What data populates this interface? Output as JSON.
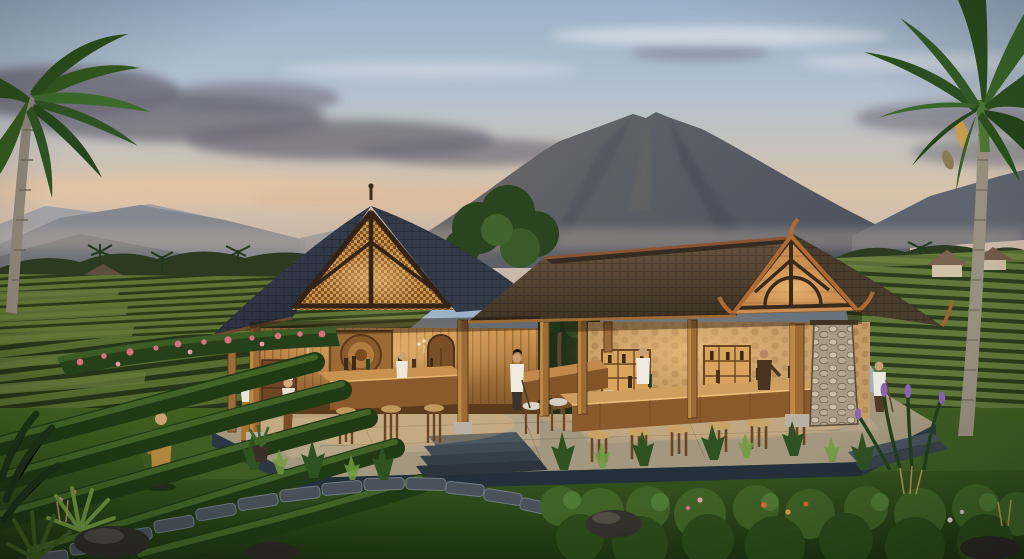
{
  "meta": {
    "type": "photorealistic-architectural-render",
    "description": "Sunset rendering of an open-air Balinese tea-house: two joined timber pavilions with steep shingled roofs and glowing carved gables, long tasting bars with wooden stools, set on a stone terrace amid terraced tea plantations, flower hedges, stepping-stone paths and royal palms, with a volcano rising behind under a peach-and-blue dusk sky.",
    "no_visible_text": true
  },
  "scene": {
    "sky": "dusk sky, blue above warm peach horizon band with grey-violet clouds",
    "mountain": "large volcano center-right with twin-notched summit",
    "left_palm": "royal palm entering frame at far left",
    "right_palm": "tall royal palm at right edge with seed pod",
    "fields": "terraced tea plantation rows left and right, two distant thatched huts",
    "building": {
      "left_pavilion": "steep slate roof, golden woven gable with dark timber trusses, carved medallion wall, tasting table with three stools",
      "right_pavilion": "brown shingle roof, lit plank gable with arched truss, river-stone walls and pillar, long bar with six stools plus cushioned stools",
      "breezeway": "open passage with small counter and courtyard tree"
    },
    "people": [
      "guest in gold robe tasting tea in the field",
      "two women in traditional dress near the steps",
      "barista in white at the breezeway",
      "barista behind the left tasting table",
      "barista in white behind the long bar",
      "server in dark vest at the bar end",
      "guest in white at the right counter"
    ],
    "garden": "flower hedge with pink blooms, fern border, stepping-stone path, boulders, agaves, purple flower spikes, clipped bush rows"
  },
  "palette": {
    "sky-top": "#9bb2ca",
    "sky-warm": "#d8c2a9",
    "mountain": "#5e6068",
    "tea-light": "#5f7434",
    "tea-dark": "#2a3a19",
    "lawn": "#3c5722",
    "roof-slate": "#3a4250",
    "roof-brown": "#65533f",
    "gable-gold": "#b37c3c",
    "wood-lit": "#c79147",
    "stone-wall": "#c49a66",
    "platform": "#a3977f",
    "glow": "#ffbe6e",
    "foliage-dark": "#2b3a21",
    "flower-pink": "#d9707e"
  }
}
